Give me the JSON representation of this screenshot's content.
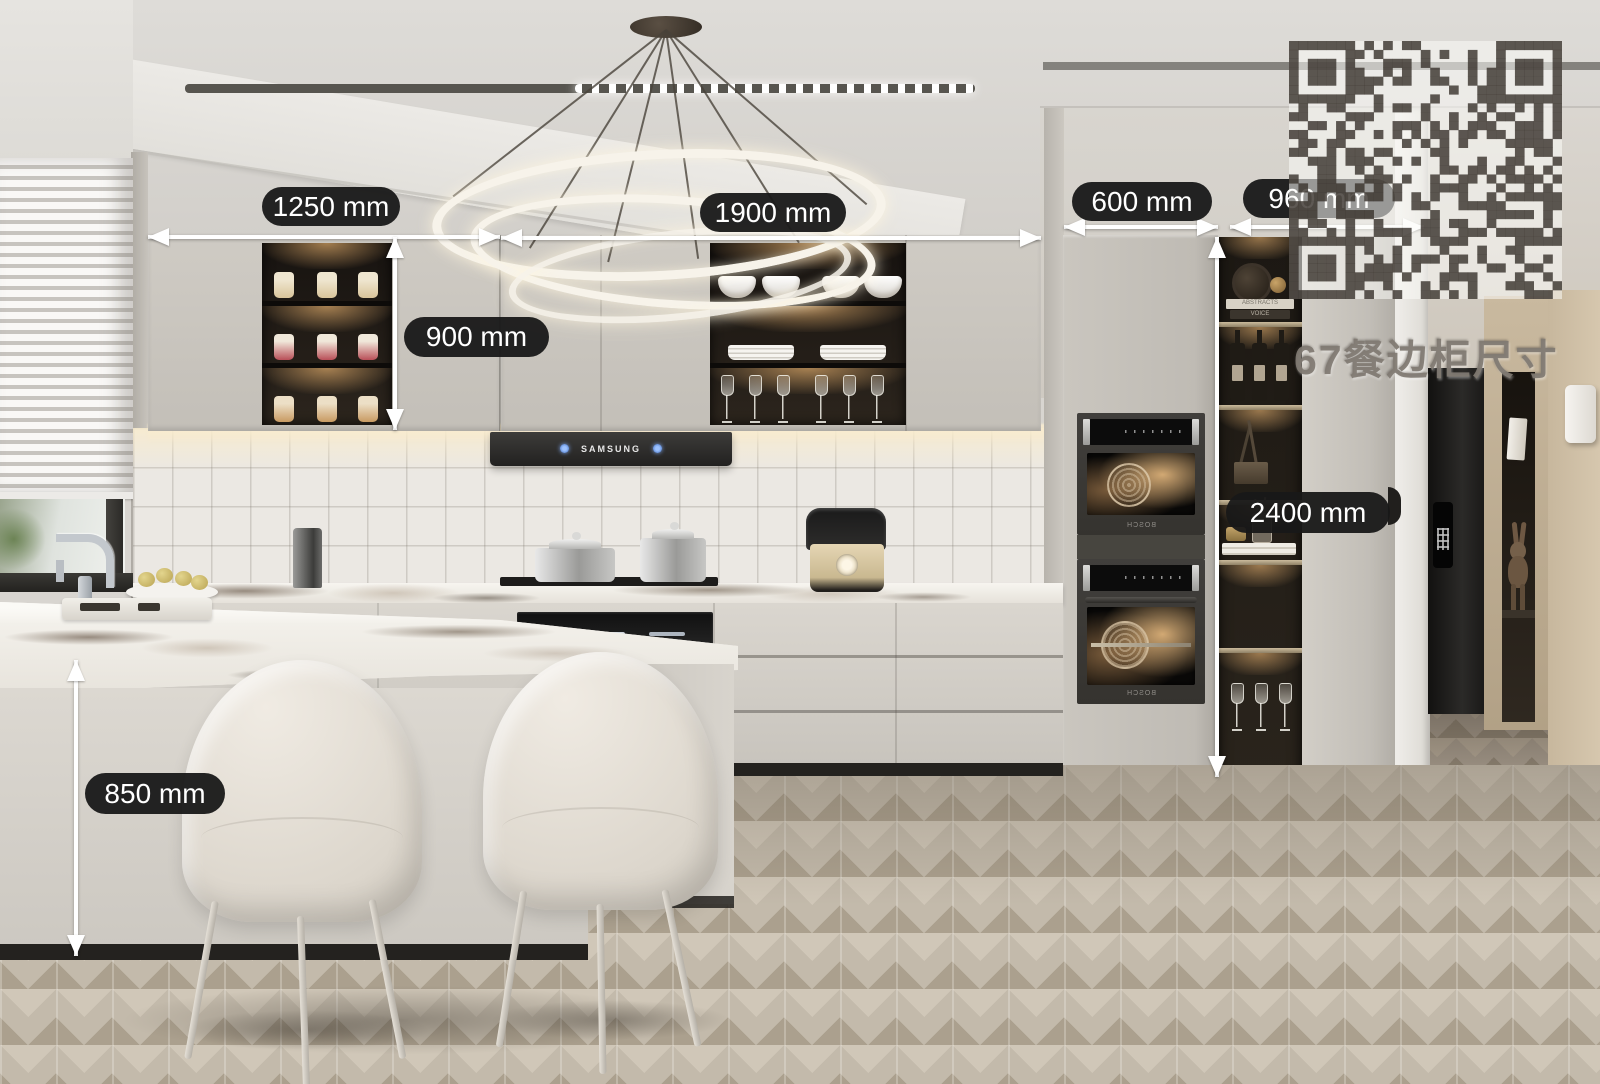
{
  "dimensions": {
    "upper_cabinet_left_width": "1250 mm",
    "upper_cabinet_mid_width": "1900 mm",
    "tall_cabinet_width": "600 mm",
    "dining_cabinet_width": "960 mm",
    "upper_cabinet_height": "900 mm",
    "tall_cabinet_height": "2400 mm",
    "island_counter_height": "850 mm"
  },
  "appliances": {
    "hood_brand": "SAMSUNG",
    "oven_top_brand": "BOSCH",
    "oven_bottom_brand": "BOSCH"
  },
  "decor": {
    "book_1": "ABSTRACTS",
    "book_2": "VOICE"
  },
  "watermark": {
    "caption": "67餐边柜尺寸"
  },
  "colors": {
    "label_bg": "#181818",
    "label_text": "#ffffff",
    "arrow": "#ffffff",
    "cabinet_greige": "#c9c5be",
    "niche_glow": "#be925c",
    "floor_wood": "#c3baab",
    "oven_body": "#3a3835",
    "wardrobe_tan": "#c4b49b"
  }
}
